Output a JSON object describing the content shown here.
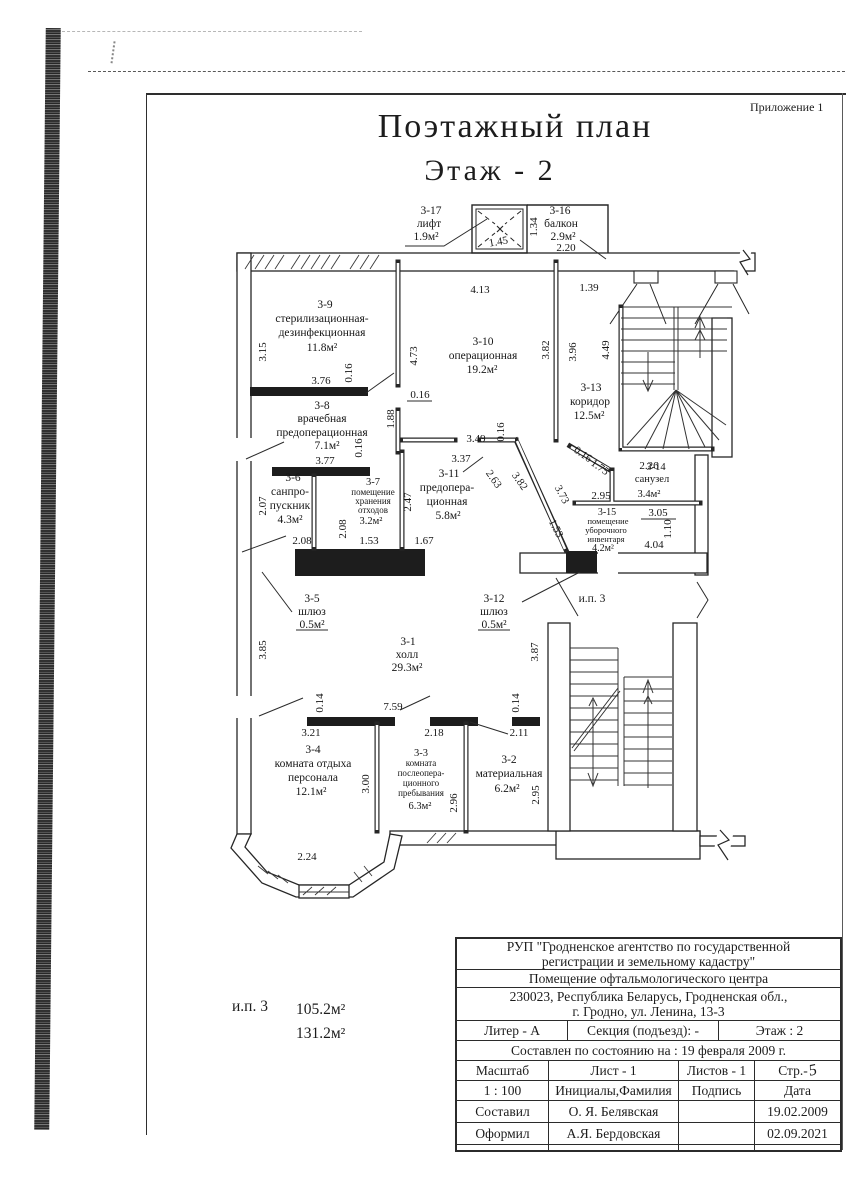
{
  "page": {
    "appendix": "Приложение 1",
    "title": "Поэтажный план",
    "subtitle": "Этаж  - 2"
  },
  "legend": {
    "label": "и.п. 3",
    "area1": "105.2м²",
    "area2": "131.2м²"
  },
  "plan": {
    "ip3": "и.п. 3",
    "rooms": {
      "r1": {
        "id": "3-1",
        "lines": [
          "холл"
        ],
        "area": "29.3м²"
      },
      "r2": {
        "id": "3-2",
        "lines": [
          "материальная"
        ],
        "area": "6.2м²"
      },
      "r3": {
        "id": "3-3",
        "lines": [
          "комната",
          "послеопера-",
          "ционного",
          "пребывания"
        ],
        "area": "6.3м²"
      },
      "r4": {
        "id": "3-4",
        "lines": [
          "комната отдыха",
          "персонала"
        ],
        "area": "12.1м²"
      },
      "r5": {
        "id": "3-5",
        "lines": [
          "шлюз"
        ],
        "area": "0.5м²"
      },
      "r6": {
        "id": "3-6",
        "lines": [
          "санпро-",
          "пускник"
        ],
        "area": "4.3м²"
      },
      "r7": {
        "id": "3-7",
        "lines": [
          "помещение",
          "хранения",
          "отходов"
        ],
        "area": "3.2м²"
      },
      "r8": {
        "id": "3-8",
        "lines": [
          "врачебная",
          "предоперационная"
        ],
        "area": "7.1м²"
      },
      "r9": {
        "id": "3-9",
        "lines": [
          "стерилизационная-",
          "дезинфекционная"
        ],
        "area": "11.8м²"
      },
      "r10": {
        "id": "3-10",
        "lines": [
          "операционная"
        ],
        "area": "19.2м²"
      },
      "r11": {
        "id": "3-11",
        "lines": [
          "предопера-",
          "ционная"
        ],
        "area": "5.8м²"
      },
      "r12": {
        "id": "3-12",
        "lines": [
          "шлюз"
        ],
        "area": "0.5м²"
      },
      "r13": {
        "id": "3-13",
        "lines": [
          "коридор"
        ],
        "area": "12.5м²"
      },
      "r14": {
        "id": "3-14",
        "lines": [
          "санузел"
        ],
        "area": "3.4м²"
      },
      "r15": {
        "id": "3-15",
        "lines": [
          "помещение",
          "уборочного",
          "инвентаря"
        ],
        "area": "4.2м²"
      },
      "r16": {
        "id": "3-16",
        "lines": [
          "балкон"
        ],
        "area": "2.9м²"
      },
      "r17": {
        "id": "3-17",
        "lines": [
          "лифт"
        ],
        "area": "1.9м²"
      }
    },
    "dv": {
      "v014": "0.14",
      "v016": "0.16",
      "v110": "1.10",
      "v134": "1.34",
      "v139": "1.39",
      "v145": "1.45",
      "v153": "1.53",
      "v167": "1.67",
      "v175": "1.75",
      "v188": "1.88",
      "v207": "2.07",
      "v208": "2.08",
      "v211": "2.11",
      "v218": "2.18",
      "v220": "2.20",
      "v224": "2.24",
      "v226": "2.26",
      "v247": "2.47",
      "v263": "2.63",
      "v295": "2.95",
      "v296": "2.96",
      "v300": "3.00",
      "v305": "3.05",
      "v315": "3.15",
      "v321": "3.21",
      "v337": "3.37",
      "v349": "3.49",
      "v373": "3.73",
      "v376": "3.76",
      "v377": "3.77",
      "v382": "3.82",
      "v385": "3.85",
      "v387": "3.87",
      "v396": "3.96",
      "v404": "4.04",
      "v413": "4.13",
      "v449": "4.49",
      "v473": "4.73",
      "v759": "7.59"
    }
  },
  "table": {
    "org1": "РУП \"Гродненское агентство по государственной",
    "org2": "регистрации  и земельному кадастру\"",
    "premises": "Помещение офтальмологического центра",
    "addr1": "230023, Республика Беларусь, Гродненская обл.,",
    "addr2": "г. Гродно, ул. Ленина, 13-3",
    "liter": "Литер - А",
    "section": "Секция (подъезд): -",
    "floor": "Этаж : 2",
    "compiled": "Составлен по состоянию на : 19 февраля 2009 г.",
    "scale_h": "Масштаб",
    "sheet": "Лист -  1",
    "sheets": "Листов - 1",
    "page_label": "Стр.-",
    "page_no": "5",
    "scale": "1 : 100",
    "initials_h": "Инициалы,Фамилия",
    "sign_h": "Подпись",
    "date_h": "Дата",
    "rows": [
      {
        "role": "Составил",
        "name": "О. Я. Белявская",
        "date": "19.02.2009"
      },
      {
        "role": "Оформил",
        "name": "А.Я. Бердовская",
        "date": "02.09.2021"
      },
      {
        "role": "Проверил",
        "name": "Т.П.С",
        "date": "02.09.2021"
      }
    ]
  }
}
